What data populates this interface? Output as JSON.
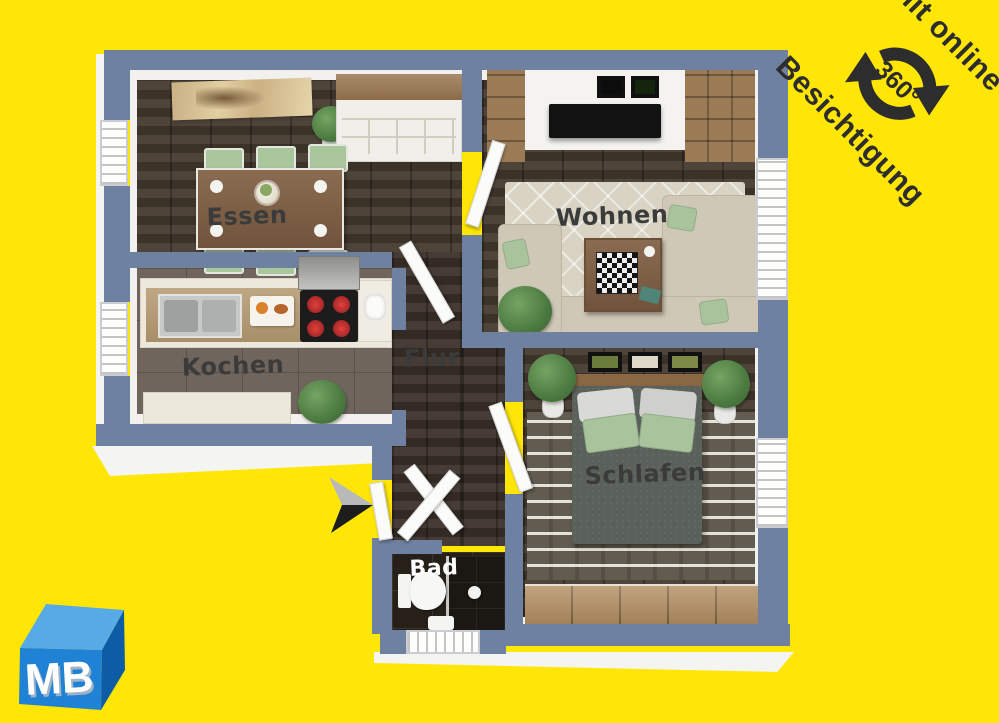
{
  "canvas": {
    "background_color": "#ffe606"
  },
  "badge": {
    "line1": "mit online",
    "line2": "Besichtigung",
    "degrees_label": "360°",
    "icon": "circular-arrows-360-icon",
    "text_color": "#2d2d2d"
  },
  "logo": {
    "text": "MB",
    "front_color": "#1f82d4",
    "top_color": "#56abe7",
    "side_color": "#0e5ca6"
  },
  "plan": {
    "wall_color": "#6f81a0",
    "floor_wood_color": "#453a2f",
    "kitchen_tile_color": "#6f655c",
    "bath_tile_color": "#262019",
    "entrance_arrow_icon": "cursor-arrow-icon",
    "rooms": {
      "essen": {
        "label": "Essen"
      },
      "wohnen": {
        "label": "Wohnen"
      },
      "kochen": {
        "label": "Kochen"
      },
      "flur": {
        "label": "Flur"
      },
      "schlafen": {
        "label": "Schlafen"
      },
      "bad": {
        "label": "Bad"
      }
    }
  }
}
